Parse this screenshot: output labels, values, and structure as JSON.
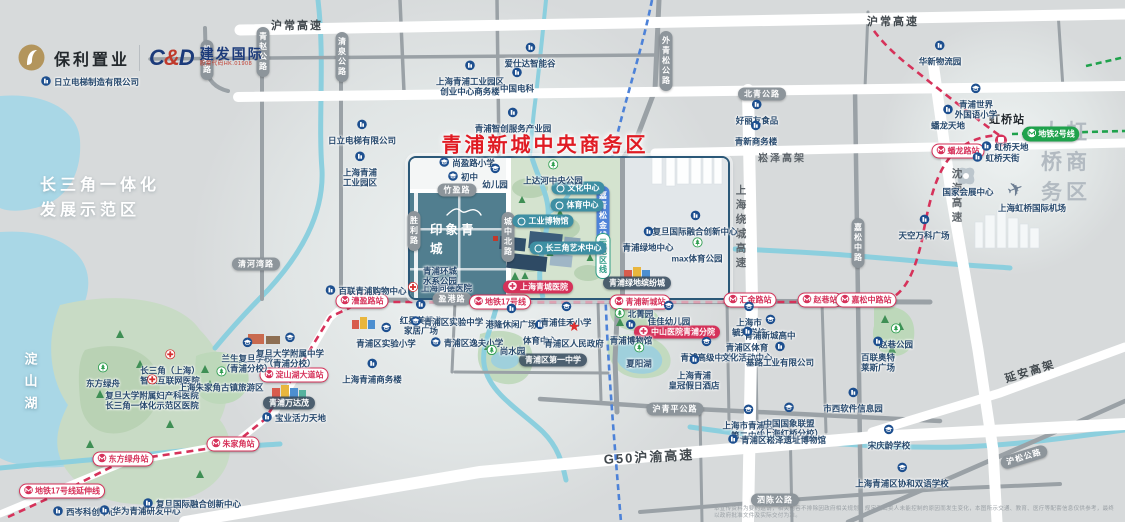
{
  "brand": {
    "poly_name": "保利置业",
    "cnd_mark_c": "C",
    "cnd_mark_amp": "&",
    "cnd_mark_d": "D",
    "cnd_name": "建发国际",
    "cnd_sub": "股票代码HK.01908"
  },
  "titles": {
    "cbd": "青浦新城中央商务区",
    "hongqiao": "大虹桥商务区",
    "demo_zone": "长三角一体化\n发展示范区",
    "lake": "淀山湖",
    "project": "印象青城",
    "hub": "虹桥站"
  },
  "colors": {
    "metro17": "#d6325a",
    "metro2": "#1fa24c",
    "planned_line": "#4d82d8",
    "cbd_red": "#e01b23",
    "road_gray": "#9aa1a6",
    "river": "#8ccfde"
  },
  "map": {
    "highways": [
      {
        "x": 297,
        "y": 25,
        "label": "沪常高速",
        "cls": "onwhite",
        "size": 11
      },
      {
        "x": 893,
        "y": 21,
        "label": "沪常高速",
        "cls": "onwhite",
        "size": 11
      },
      {
        "x": 782,
        "y": 157,
        "label": "崧泽高架",
        "cls": "",
        "size": 10
      },
      {
        "x": 741,
        "y": 228,
        "label": "上海绕城高速",
        "cls": "vert",
        "size": 10.5
      },
      {
        "x": 957,
        "y": 197,
        "label": "沈海高速",
        "cls": "vert",
        "size": 10.5
      },
      {
        "x": 1030,
        "y": 371,
        "label": "延安高架",
        "cls": "onwhite",
        "size": 11,
        "rot": -17
      },
      {
        "x": 649,
        "y": 456,
        "label": "G50沪渝高速",
        "cls": "onwhite",
        "size": 13,
        "rot": -3
      }
    ],
    "road_pills": [
      {
        "x": 207,
        "y": 60,
        "label": "机场路",
        "vert": true
      },
      {
        "x": 263,
        "y": 52,
        "label": "青赵公路",
        "vert": true
      },
      {
        "x": 342,
        "y": 57,
        "label": "清泉公路",
        "vert": true
      },
      {
        "x": 666,
        "y": 61,
        "label": "外青松公路",
        "vert": true
      },
      {
        "x": 762,
        "y": 94,
        "label": "北青公路"
      },
      {
        "x": 858,
        "y": 243,
        "label": "嘉松中路",
        "vert": true
      },
      {
        "x": 256,
        "y": 264,
        "label": "清河湾路"
      },
      {
        "x": 457,
        "y": 190,
        "label": "竹盈路"
      },
      {
        "x": 414,
        "y": 231,
        "label": "胜利路",
        "vert": true
      },
      {
        "x": 508,
        "y": 237,
        "label": "城中北路",
        "vert": true
      },
      {
        "x": 452,
        "y": 299,
        "label": "盈港路"
      },
      {
        "x": 675,
        "y": 409,
        "label": "沪青平公路"
      },
      {
        "x": 775,
        "y": 500,
        "label": "泗陈公路"
      },
      {
        "x": 1024,
        "y": 457,
        "label": "沪松公路",
        "rot": -17
      }
    ],
    "stations": [
      {
        "x": 62,
        "y": 491,
        "label": "地铁17号线延伸线"
      },
      {
        "x": 123,
        "y": 459,
        "label": "东方绿舟站"
      },
      {
        "x": 233,
        "y": 444,
        "label": "朱家角站"
      },
      {
        "x": 294,
        "y": 375,
        "label": "淀山湖大道站"
      },
      {
        "x": 362,
        "y": 301,
        "label": "漕盈路站"
      },
      {
        "x": 500,
        "y": 302,
        "label": "地铁17号线"
      },
      {
        "x": 640,
        "y": 302,
        "label": "青浦新城站"
      },
      {
        "x": 750,
        "y": 300,
        "label": "汇金路站"
      },
      {
        "x": 820,
        "y": 300,
        "label": "赵巷站"
      },
      {
        "x": 866,
        "y": 300,
        "label": "嘉松中路站"
      },
      {
        "x": 958,
        "y": 151,
        "label": "蟠龙路站"
      }
    ],
    "line_badges": [
      {
        "x": 1051,
        "y": 134,
        "label": "地铁2号线",
        "kind": "green"
      },
      {
        "x": 603,
        "y": 216,
        "label": "嘉青松金线",
        "kind": "blue"
      },
      {
        "x": 603,
        "y": 256,
        "label": "示范区线",
        "kind": "tealvert"
      }
    ],
    "red_badges": [
      {
        "x": 538,
        "y": 287,
        "label": "上海青城医院"
      },
      {
        "x": 677,
        "y": 332,
        "label": "中山医院青浦分院"
      }
    ],
    "dark_badges": [
      {
        "x": 289,
        "y": 403,
        "label": "青浦万达茂"
      },
      {
        "x": 553,
        "y": 360,
        "label": "青浦区第一中学"
      },
      {
        "x": 637,
        "y": 283,
        "label": "青浦绿地缤纷城"
      }
    ],
    "teal_badges": [
      {
        "x": 578,
        "y": 188,
        "label": "文化中心"
      },
      {
        "x": 577,
        "y": 205,
        "label": "体育中心"
      },
      {
        "x": 543,
        "y": 221,
        "label": "工业博物馆"
      },
      {
        "x": 568,
        "y": 248,
        "label": "长三角艺术中心"
      }
    ],
    "pois": [
      {
        "x": 90,
        "y": 82,
        "icon": "biz",
        "layout": "inline",
        "label": "日立电梯制造有限公司"
      },
      {
        "x": 362,
        "y": 131,
        "icon": "biz",
        "label": "日立电梯有限公司"
      },
      {
        "x": 360,
        "y": 168,
        "icon": "biz",
        "label": "上海青浦\n工业园区"
      },
      {
        "x": 530,
        "y": 54,
        "icon": "biz",
        "label": "爱仕达智能谷"
      },
      {
        "x": 470,
        "y": 77,
        "icon": "biz",
        "label": "上海青浦工业园区\n创业中心商务楼"
      },
      {
        "x": 517,
        "y": 79,
        "icon": "biz",
        "label": "中国电科"
      },
      {
        "x": 513,
        "y": 119,
        "icon": "biz",
        "label": "青浦智创服务产业园"
      },
      {
        "x": 757,
        "y": 111,
        "icon": "biz",
        "label": "好丽友食品"
      },
      {
        "x": 756,
        "y": 132,
        "icon": "biz",
        "label": "青新商务楼"
      },
      {
        "x": 940,
        "y": 52,
        "icon": "biz",
        "label": "华新物流园"
      },
      {
        "x": 103,
        "y": 374,
        "icon": "tree",
        "label": "东方绿舟"
      },
      {
        "x": 170,
        "y": 366,
        "icon": "cross",
        "label": "长三角（上海）\n智慧互联网医院"
      },
      {
        "x": 152,
        "y": 391,
        "icon": "cross",
        "label": "复旦大学附属妇产科医院\n长三角一体化示范区医院"
      },
      {
        "x": 221,
        "y": 378,
        "icon": "tree",
        "label": "上海朱家角古镇旅游区"
      },
      {
        "x": 247,
        "y": 354,
        "icon": "school",
        "label": "兰生复旦学校\n（青浦分校）"
      },
      {
        "x": 290,
        "y": 349,
        "icon": "school",
        "label": "复旦大学附属中学\n（青浦分校）"
      },
      {
        "x": 294,
        "y": 418,
        "icon": "biz",
        "layout": "inline",
        "label": "宝业活力天地"
      },
      {
        "x": 366,
        "y": 291,
        "icon": "biz",
        "layout": "inline",
        "label": "百联青浦购物中心"
      },
      {
        "x": 386,
        "y": 334,
        "icon": "school",
        "label": "青浦区实验小学"
      },
      {
        "x": 372,
        "y": 370,
        "icon": "biz",
        "label": "上海青浦商务楼"
      },
      {
        "x": 440,
        "y": 288,
        "icon": "cross",
        "layout": "inline",
        "label": "上海同德医院"
      },
      {
        "x": 421,
        "y": 316,
        "icon": "biz",
        "label": "红星美凯龙\n家居广场"
      },
      {
        "x": 447,
        "y": 322,
        "icon": "school",
        "layout": "inline",
        "label": "青浦区实验中学"
      },
      {
        "x": 467,
        "y": 343,
        "icon": "school",
        "layout": "inline",
        "label": "青浦区逸夫小学"
      },
      {
        "x": 511,
        "y": 315,
        "icon": "biz",
        "label": "港隆休闲广场"
      },
      {
        "x": 540,
        "y": 331,
        "icon": "biz",
        "label": "体育中心"
      },
      {
        "x": 506,
        "y": 351,
        "icon": "tree",
        "layout": "inline",
        "label": "尚水园"
      },
      {
        "x": 566,
        "y": 313,
        "icon": "school",
        "label": "青浦佳禾小学"
      },
      {
        "x": 574,
        "y": 334,
        "icon": "star",
        "label": "青浦区人民政府"
      },
      {
        "x": 85,
        "y": 512,
        "icon": "biz",
        "layout": "inline",
        "label": "西岑科创中心"
      },
      {
        "x": 140,
        "y": 511,
        "icon": "biz",
        "layout": "inline",
        "label": "华为青浦研发中心"
      },
      {
        "x": 192,
        "y": 504,
        "icon": "biz",
        "layout": "inline",
        "label": "复旦国际融合创新中心"
      },
      {
        "x": 467,
        "y": 163,
        "icon": "school",
        "layout": "inline",
        "label": "尚盈路小学"
      },
      {
        "x": 463,
        "y": 177,
        "icon": "school",
        "layout": "inline",
        "label": "初中"
      },
      {
        "x": 495,
        "y": 175,
        "icon": "school",
        "label": "幼儿园"
      },
      {
        "x": 553,
        "y": 171,
        "icon": "tree",
        "label": "上达河中央公园"
      },
      {
        "x": 440,
        "y": 276,
        "icon": "none",
        "label": "青浦环城\n水系公园"
      },
      {
        "x": 695,
        "y": 222,
        "icon": "biz",
        "label": "复旦国际融合创新中心"
      },
      {
        "x": 648,
        "y": 238,
        "icon": "biz",
        "label": "青浦绿地中心"
      },
      {
        "x": 697,
        "y": 249,
        "icon": "tree",
        "label": "max体育公园"
      },
      {
        "x": 634,
        "y": 314,
        "icon": "tree",
        "layout": "inline",
        "label": "北菁园"
      },
      {
        "x": 669,
        "y": 312,
        "icon": "school",
        "label": "佳佳幼儿园"
      },
      {
        "x": 631,
        "y": 331,
        "icon": "biz",
        "label": "青浦博物馆"
      },
      {
        "x": 639,
        "y": 354,
        "icon": "tree",
        "label": "夏阳湖"
      },
      {
        "x": 706,
        "y": 348,
        "icon": "school",
        "label": "青浦高级中学"
      },
      {
        "x": 694,
        "y": 371,
        "icon": "biz",
        "label": "上海青浦\n皇冠假日酒店"
      },
      {
        "x": 749,
        "y": 318,
        "icon": "school",
        "label": "上海市\n毓秀学校"
      },
      {
        "x": 770,
        "y": 326,
        "icon": "school",
        "label": "青浦新城高中"
      },
      {
        "x": 747,
        "y": 343,
        "icon": "biz",
        "label": "青浦区体育\n文化活动中心"
      },
      {
        "x": 780,
        "y": 353,
        "icon": "biz",
        "label": "基路工业有限公司"
      },
      {
        "x": 896,
        "y": 335,
        "icon": "tree",
        "label": "赵巷公园"
      },
      {
        "x": 878,
        "y": 353,
        "icon": "biz",
        "label": "百联奥特\n莱斯广场"
      },
      {
        "x": 853,
        "y": 399,
        "icon": "biz",
        "label": "市西软件信息园"
      },
      {
        "x": 889,
        "y": 436,
        "icon": "school",
        "label": "宋庆龄学校"
      },
      {
        "x": 902,
        "y": 474,
        "icon": "school",
        "label": "上海青浦区协和双语学校"
      },
      {
        "x": 748,
        "y": 421,
        "icon": "school",
        "label": "上海市青浦区\n第二中学"
      },
      {
        "x": 789,
        "y": 419,
        "icon": "school",
        "label": "中国国象联盟\n（上海红桥分校）"
      },
      {
        "x": 777,
        "y": 440,
        "icon": "biz",
        "layout": "inline",
        "label": "青浦区崧泽遗址博物馆"
      },
      {
        "x": 924,
        "y": 226,
        "icon": "biz",
        "label": "天空万科广场"
      },
      {
        "x": 948,
        "y": 116,
        "icon": "biz",
        "label": "蟠龙天地"
      },
      {
        "x": 976,
        "y": 100,
        "icon": "school",
        "label": "青浦世界\n外国语小学"
      },
      {
        "x": 1005,
        "y": 147,
        "icon": "biz",
        "layout": "inline",
        "label": "虹桥天地"
      },
      {
        "x": 996,
        "y": 158,
        "icon": "biz",
        "layout": "inline",
        "label": "虹桥天街"
      },
      {
        "x": 968,
        "y": 192,
        "icon": "none",
        "label": "国家会展中心"
      },
      {
        "x": 1032,
        "y": 208,
        "icon": "none",
        "label": "上海虹桥国际机场"
      }
    ]
  },
  "disclaimer": "本宣传资料为要约邀请，相关内容不排除因政府相关规划、规定及出卖人未能控制的原因而发生变化，本图所示交通、教育、医疗等配套信息仅供参考，最终以政府批准文件及实际交付为准。"
}
